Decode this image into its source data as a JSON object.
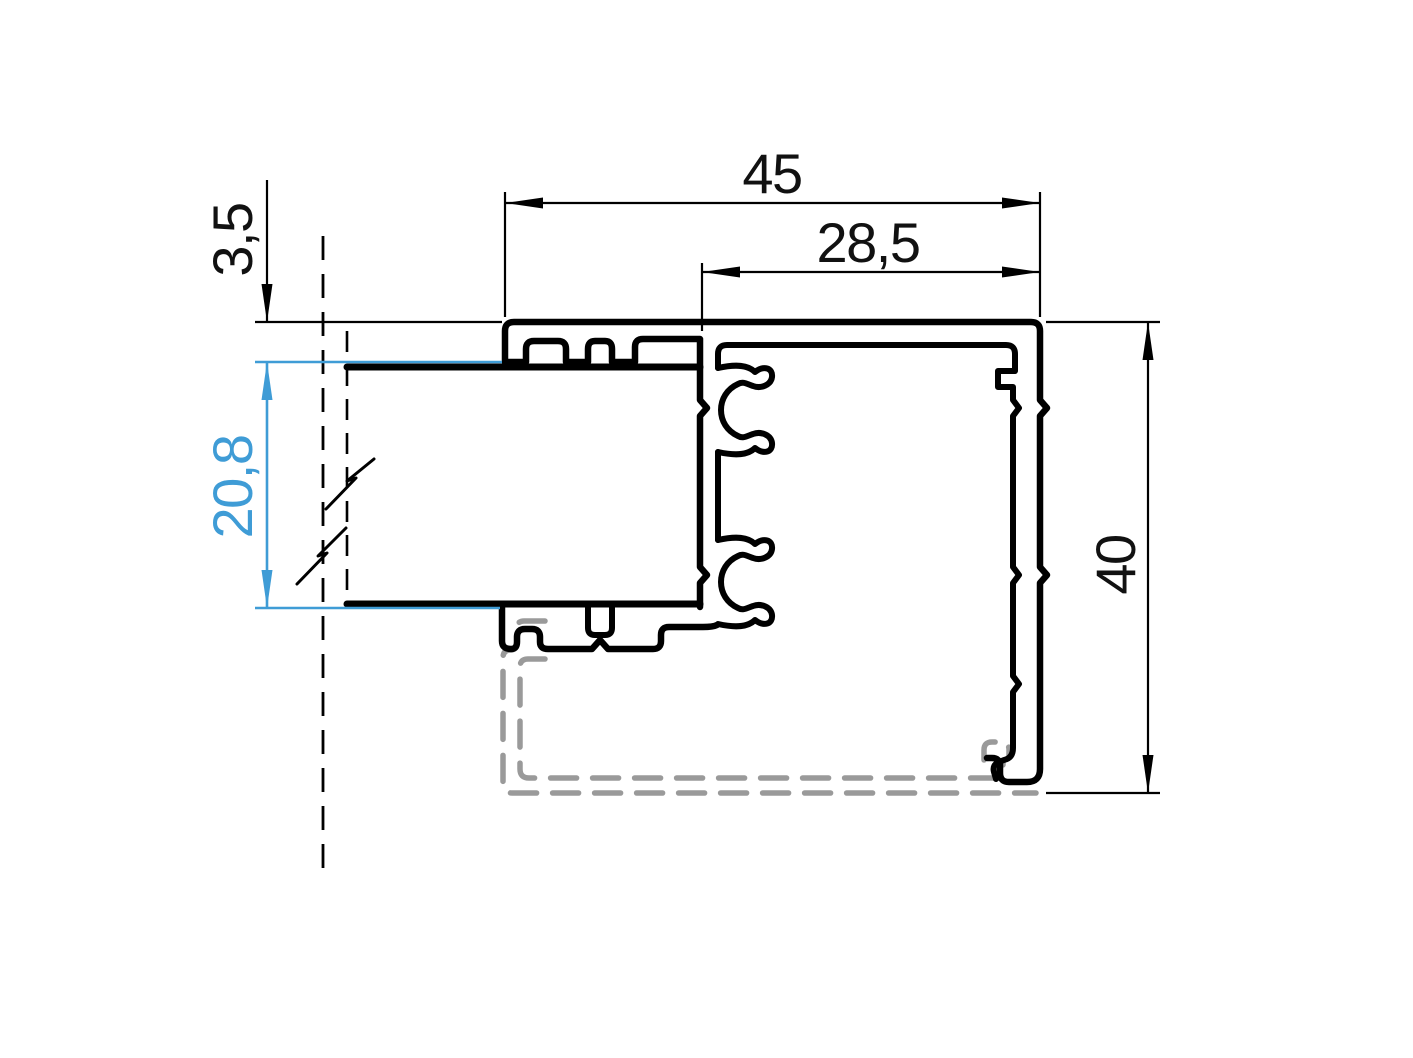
{
  "colors": {
    "line": "#000000",
    "accent": "#3f9cd6",
    "phantom": "#9a9a9a",
    "background": "#ffffff"
  },
  "dimensions": {
    "overall_width": {
      "label": "45"
    },
    "partial_width": {
      "label": "28,5"
    },
    "top_offset": {
      "label": "3,5"
    },
    "glazing_thickness": {
      "label": "20,8"
    },
    "overall_height": {
      "label": "40"
    }
  }
}
